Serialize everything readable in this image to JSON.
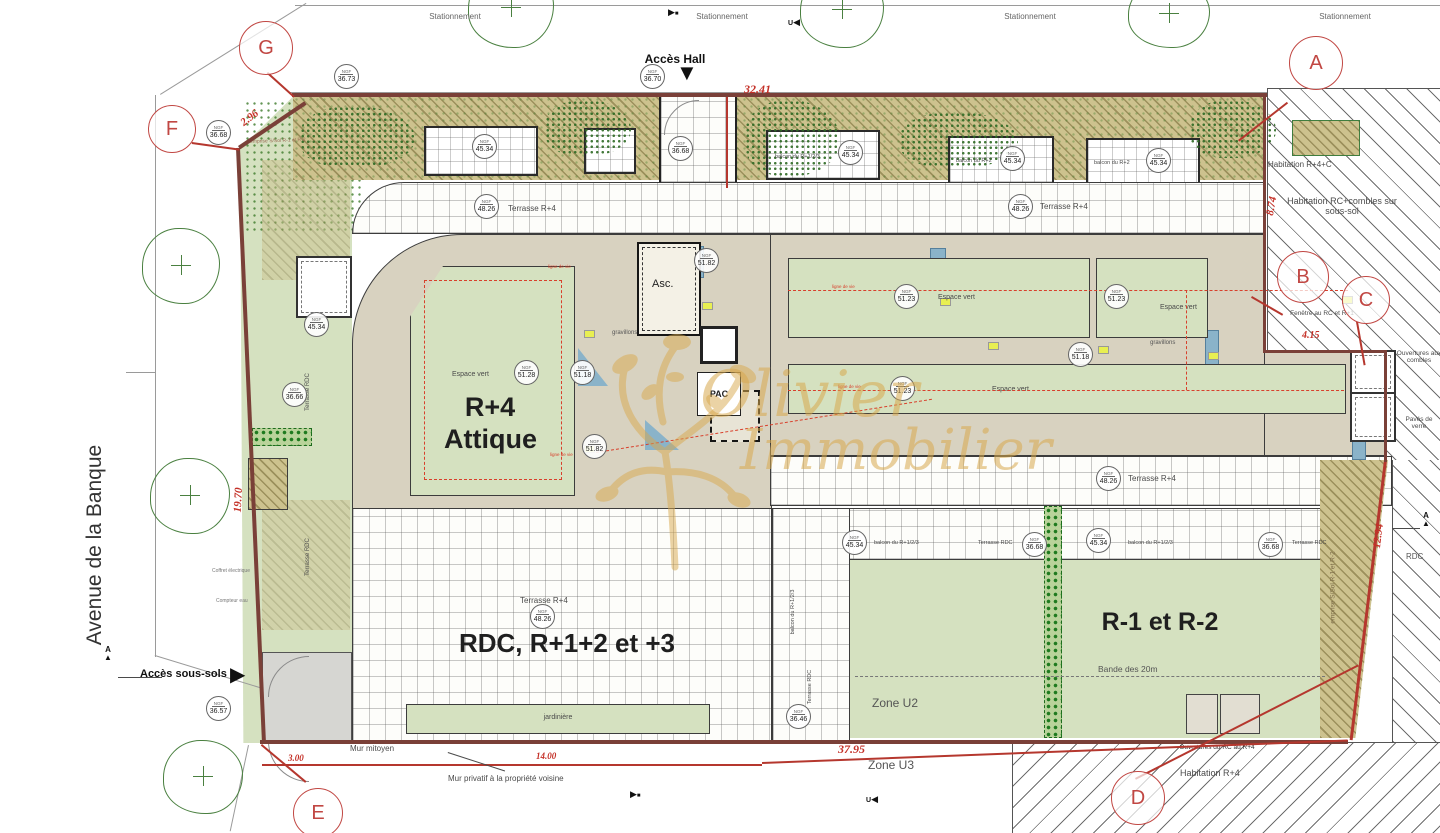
{
  "watermark": {
    "name_1": "Olivier",
    "name_2": "Immobilier"
  },
  "labels": {
    "stationnement": "Stationnement",
    "acces_hall": "Accès Hall",
    "acces_sous_sols": "Accès sous-sols",
    "avenue": "Avenue de la Banque",
    "attique_1": "R+4",
    "attique_2": "Attique",
    "rdc_floors": "RDC, R+1+2 et +3",
    "r1r2": "R-1 et R-2",
    "asc": "Asc.",
    "pac": "PAC",
    "espace_vert": "Espace vert",
    "gravillons": "gravillons",
    "terrasse_r4": "Terrasse R+4",
    "terrasse_rdc": "Terrasse RDC",
    "balcon_r123": "balcon du R+1/2/3",
    "balcon_r2": "balcon du R+2",
    "jardiniere": "jardinière",
    "mur_mitoyen": "Mur mitoyen",
    "mur_privatif": "Mur privatif à la propriété voisine",
    "zone_u2": "Zone U2",
    "zone_u3": "Zone U3",
    "bande_20m": "Bande des 20m",
    "hab_r4c": "Habitation R+4+C",
    "hab_rc_combles": "Habitation RC+combles sur sous-sol",
    "hab_r4": "Habitation R+4",
    "fenetre_rc": "Fenêtre au RC et R+1",
    "ouv_combles": "Ouvertures aux combles",
    "ouv_rc_r4": "Ouvertures du RC au R+4",
    "paves_verre": "Pavés de verre",
    "rdc_short": "RDC",
    "emprise": "emprise S/Sol R-1 et R-2",
    "ligne_de_vie": "ligne de vie",
    "coffret": "Coffret électrique",
    "compteur": "Compteur eau",
    "ngf": "NGF"
  },
  "dimensions": {
    "top": "32.41",
    "corner": "2.96",
    "right_upper": "8.74",
    "right_mid": "4.15",
    "left": "19.70",
    "right_lower": "12.94",
    "bottom": "37.95",
    "bottom_left": "3.00",
    "bottom_mid": "14.00"
  },
  "ref_letters": {
    "a": "A",
    "b": "B",
    "c": "C",
    "d": "D",
    "e": "E",
    "f": "F",
    "g": "G"
  },
  "elevations": {
    "e3646": "36.46",
    "e3657": "36.57",
    "e3666": "36.66",
    "e3668": "36.68",
    "e3670": "36.70",
    "e3673": "36.73",
    "e4534": "45.34",
    "e4826": "48.26",
    "e5118": "51.18",
    "e5123": "51.23",
    "e5128": "51.28",
    "e5182": "51.82"
  },
  "symbols": {
    "tri_down": "▼",
    "tri_right": "▶",
    "tri_left": "◀",
    "tri_up": "▲",
    "square": "■",
    "letter_a": "A",
    "letter_u": "U"
  },
  "colors": {
    "boundary_red": "#7a4038",
    "dim_red": "#c43027",
    "ref_red": "#c14743",
    "green_area": "#d5e1c0",
    "hedge_green": "#1f7a1f",
    "khaki_hatch": "#cdc28e",
    "attic_beige": "#d8d2c0",
    "watermark_gold": "#d8a94e",
    "glass_blue": "#8ab3c9"
  }
}
